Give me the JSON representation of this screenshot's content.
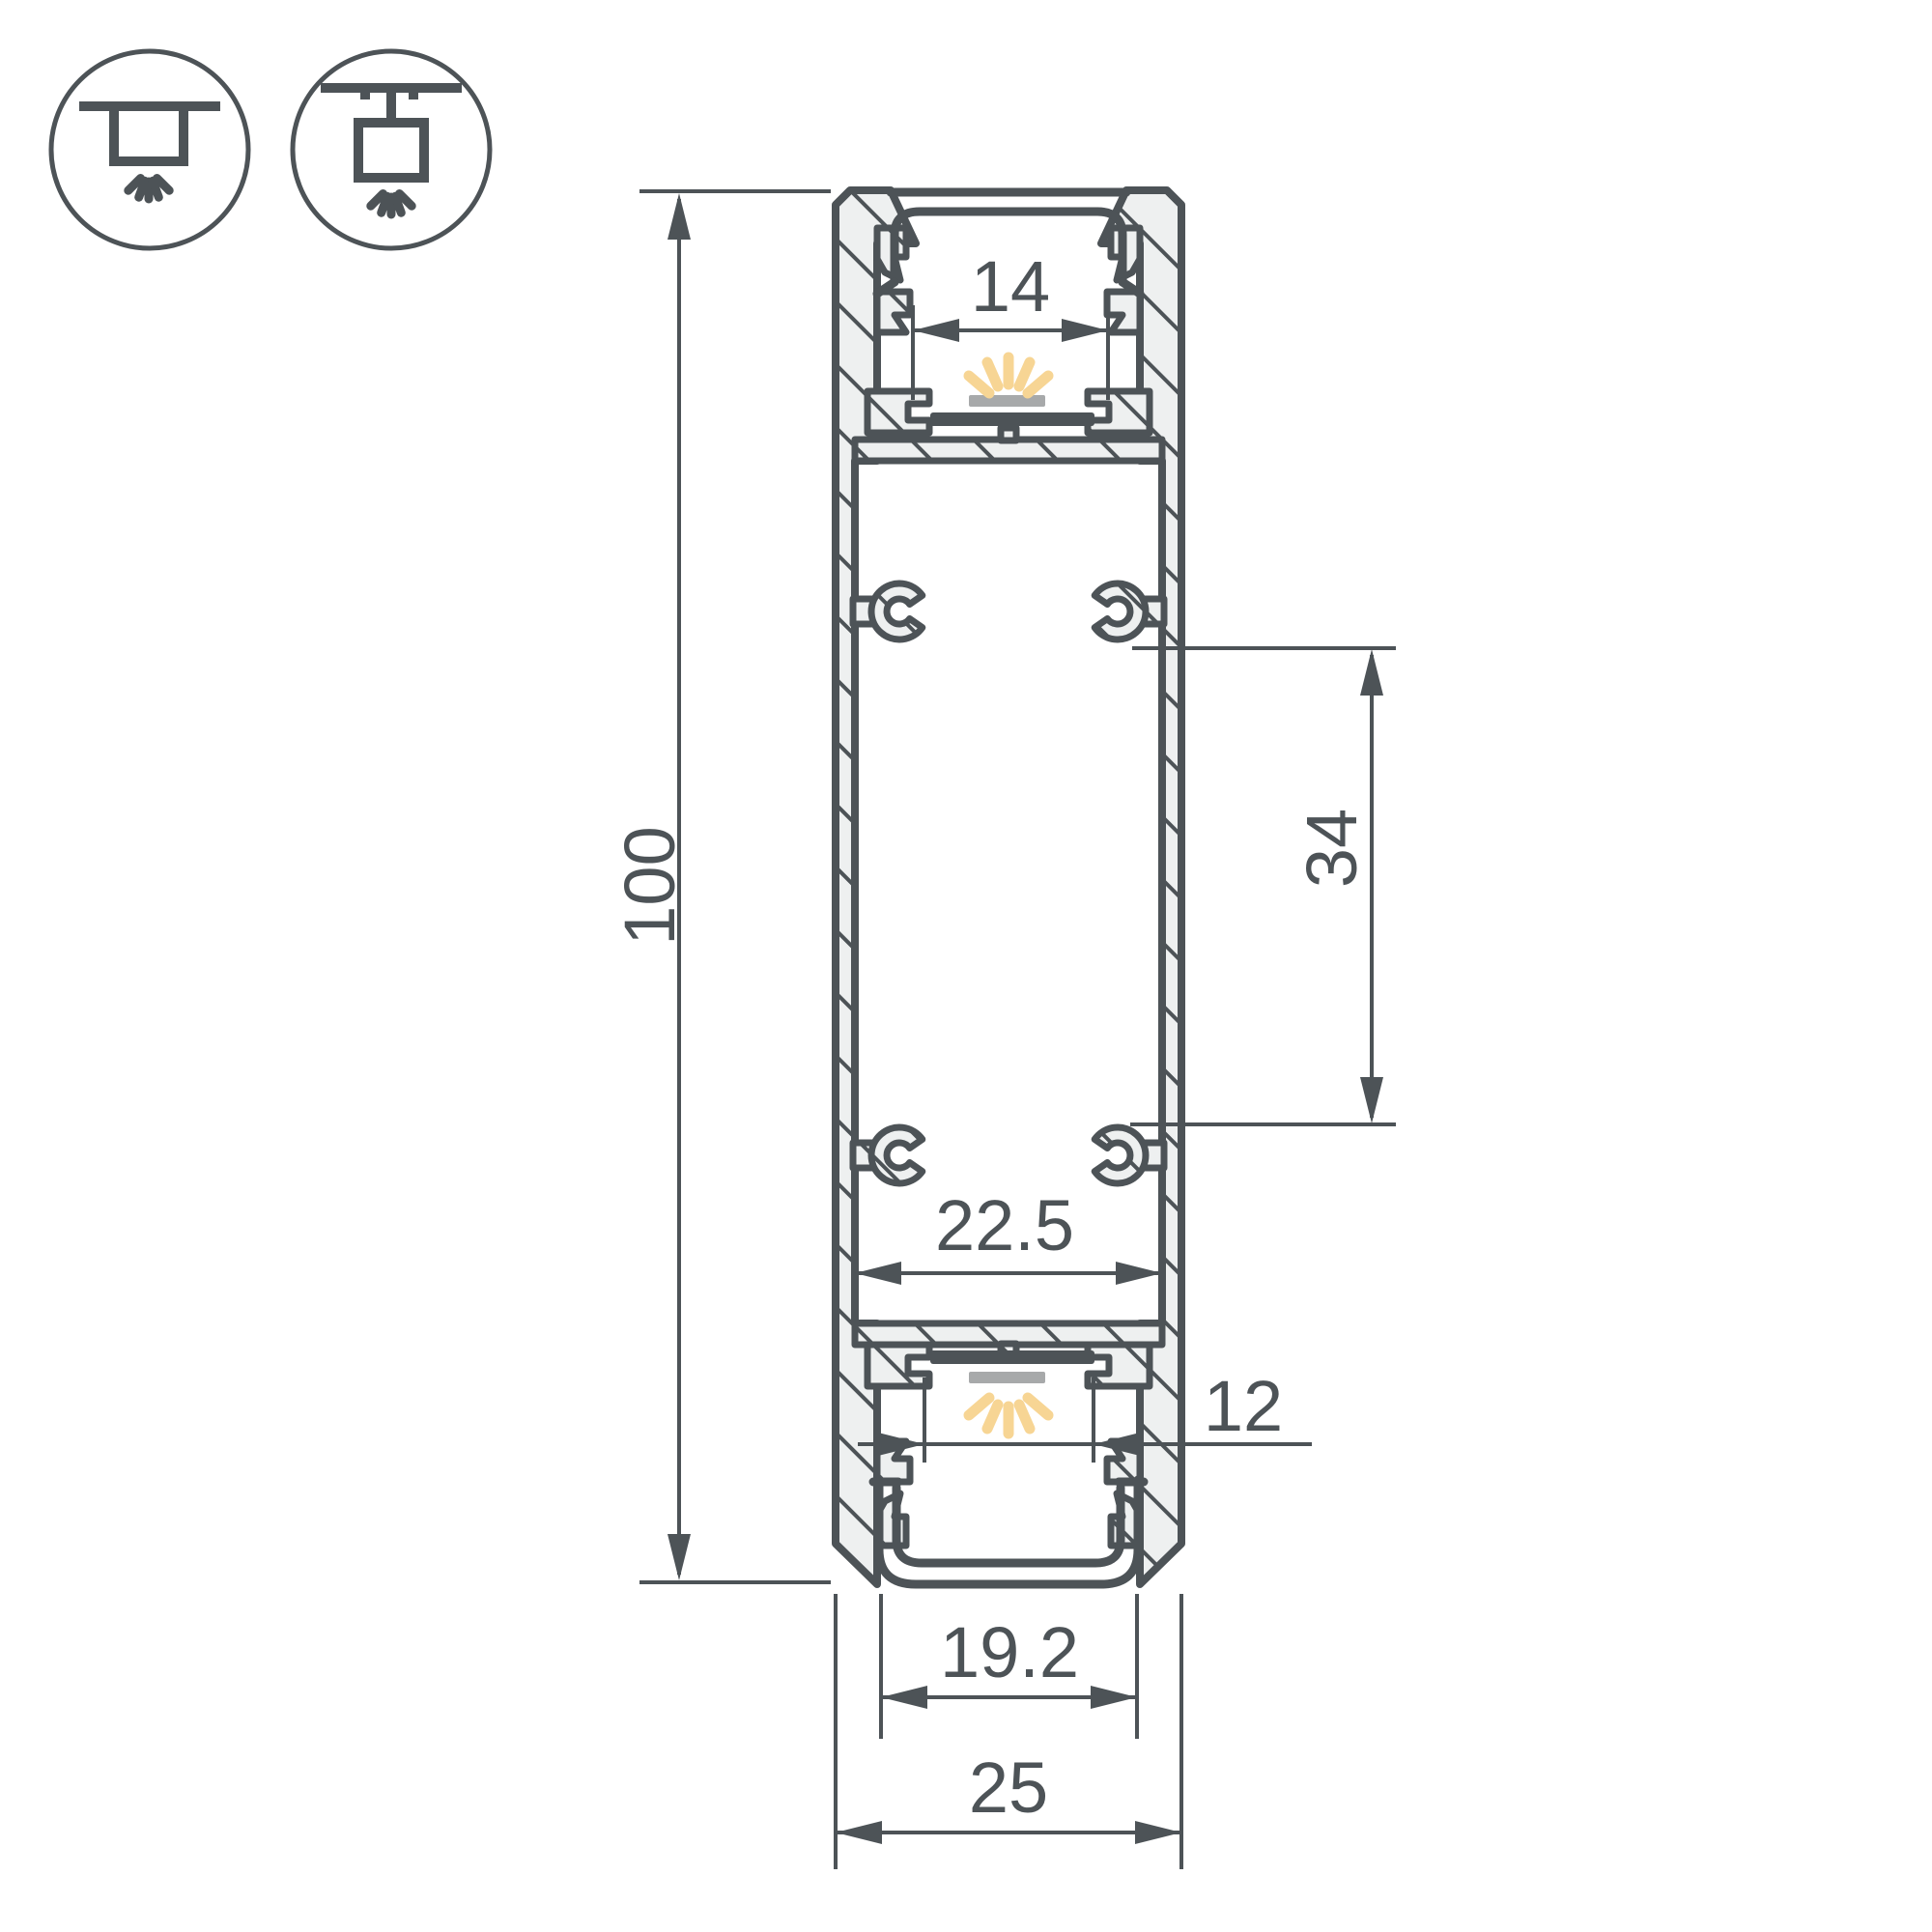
{
  "page": {
    "background": "#ffffff"
  },
  "legend": {
    "icons": [
      {
        "name": "recessed-mount-icon",
        "meaning": "recessed ceiling mounting, light down"
      },
      {
        "name": "surface-mount-icon",
        "meaning": "surface / suspended mounting, light down"
      }
    ]
  },
  "drawing": {
    "type": "led-profile-cross-section",
    "units": "mm",
    "dimensions": {
      "overall_height": "100",
      "overall_width": "25",
      "top_window": "14",
      "mount_pitch": "34",
      "inner_width": "22.5",
      "strip_window": "12",
      "bottom_window": "19.2"
    },
    "colors": {
      "line": "#4d5357",
      "aluminum_fill": "#eef0f0",
      "glow": "#f7d594",
      "led_surface": "#a7a9aa",
      "background": "#ffffff"
    }
  }
}
